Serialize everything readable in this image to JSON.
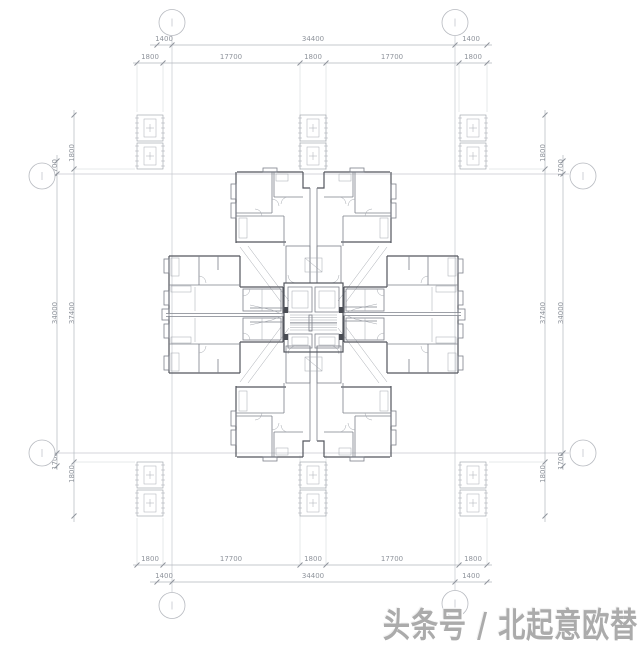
{
  "watermark": {
    "text": "头条号 / 北起意欧替",
    "color": "#ababab"
  },
  "colors": {
    "background": "#ffffff",
    "grid_line": "#c6c9cf",
    "dimension_line": "#b4b8bf",
    "dimension_text": "#8f949c",
    "wall_dark": "#53565e",
    "wall_medium": "#7d818a",
    "watermark_gray": "#ababab"
  },
  "dimension_labels": [
    {
      "t": "1400",
      "x": 164,
      "y": 41,
      "r": 0
    },
    {
      "t": "34400",
      "x": 313,
      "y": 41,
      "r": 0
    },
    {
      "t": "1400",
      "x": 471,
      "y": 41,
      "r": 0
    },
    {
      "t": "1800",
      "x": 150,
      "y": 59,
      "r": 0
    },
    {
      "t": "17700",
      "x": 231,
      "y": 59,
      "r": 0
    },
    {
      "t": "1800",
      "x": 313,
      "y": 59,
      "r": 0
    },
    {
      "t": "17700",
      "x": 392,
      "y": 59,
      "r": 0
    },
    {
      "t": "1800",
      "x": 473,
      "y": 59,
      "r": 0
    },
    {
      "t": "1800",
      "x": 150,
      "y": 561,
      "r": 0
    },
    {
      "t": "17700",
      "x": 231,
      "y": 561,
      "r": 0
    },
    {
      "t": "1800",
      "x": 313,
      "y": 561,
      "r": 0
    },
    {
      "t": "17700",
      "x": 392,
      "y": 561,
      "r": 0
    },
    {
      "t": "1800",
      "x": 473,
      "y": 561,
      "r": 0
    },
    {
      "t": "1400",
      "x": 164,
      "y": 578,
      "r": 0
    },
    {
      "t": "34400",
      "x": 313,
      "y": 578,
      "r": 0
    },
    {
      "t": "1400",
      "x": 471,
      "y": 578,
      "r": 0
    },
    {
      "t": "1700",
      "x": 57,
      "y": 168,
      "r": -90
    },
    {
      "t": "34000",
      "x": 57,
      "y": 313,
      "r": -90
    },
    {
      "t": "1700",
      "x": 57,
      "y": 461,
      "r": -90
    },
    {
      "t": "1800",
      "x": 74,
      "y": 153,
      "r": -90
    },
    {
      "t": "37400",
      "x": 74,
      "y": 313,
      "r": -90
    },
    {
      "t": "1800",
      "x": 74,
      "y": 474,
      "r": -90
    },
    {
      "t": "1800",
      "x": 545,
      "y": 153,
      "r": -90
    },
    {
      "t": "37400",
      "x": 545,
      "y": 313,
      "r": -90
    },
    {
      "t": "1800",
      "x": 545,
      "y": 474,
      "r": -90
    },
    {
      "t": "1700",
      "x": 563,
      "y": 168,
      "r": -90
    },
    {
      "t": "34000",
      "x": 563,
      "y": 313,
      "r": -90
    },
    {
      "t": "1700",
      "x": 563,
      "y": 461,
      "r": -90
    }
  ],
  "axis_bubbles": [
    {
      "x": 172,
      "y": 22.5
    },
    {
      "x": 455,
      "y": 22.5
    },
    {
      "x": 42,
      "y": 176
    },
    {
      "x": 583,
      "y": 176
    },
    {
      "x": 42,
      "y": 453
    },
    {
      "x": 583,
      "y": 453
    },
    {
      "x": 172,
      "y": 605.5
    },
    {
      "x": 455,
      "y": 603.5
    }
  ]
}
